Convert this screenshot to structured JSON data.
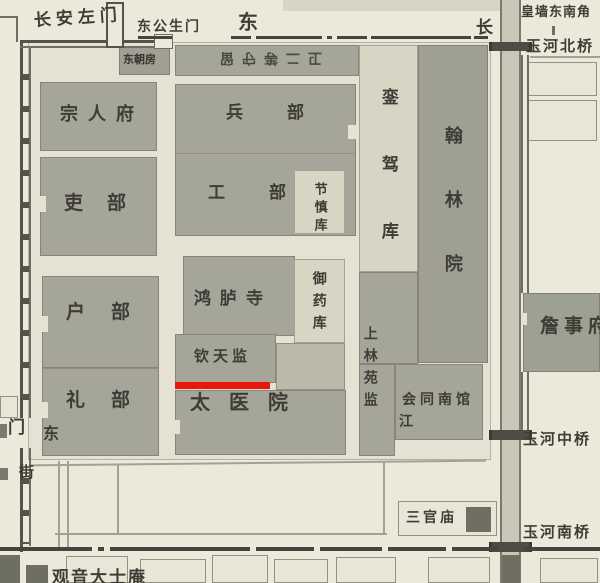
{
  "map": {
    "description": "Historical map detail of government offices southeast of the imperial wall, with Qintianjian underlined in red",
    "highlight_color": "#e8170c",
    "labels": {
      "changan_left_gate": "长安左门",
      "dong_gongsheng_gate": "东公生门",
      "street_dong": "东",
      "street_chang": "长",
      "huangqiang_corner": "皇墙东南角",
      "yuhe_north_bridge": "玉河北桥",
      "dong_chaofang": "东朝房",
      "guard_strip_inverted": "卫二等守留",
      "zongrenfu": "宗人府",
      "libu_officials": "吏部",
      "hubu": "户部",
      "libu_rites": "礼部",
      "dong_corner": "东",
      "bingbu": "兵部",
      "gongbu": "工部",
      "jieshenku": "节慎库",
      "honglusi": "鸿胪寺",
      "yuyaoku": "御药库",
      "qintianjian": "钦天监",
      "taiyiyuan": "太医院",
      "luanjiaku": "銮驾库",
      "hanlinyuan": "翰林院",
      "shanglin_yuanjian": "上林苑监",
      "huitong_nanguan": "会同南馆",
      "jiang": "江",
      "zhanshifu": "詹事府",
      "yuhe_middle_bridge": "玉河中桥",
      "sanguanmiao": "三官庙",
      "yuhe_south_bridge": "玉河南桥",
      "gate_partial": "门",
      "street_partial": "街",
      "guanyin_temple": "观音大士庵"
    }
  }
}
